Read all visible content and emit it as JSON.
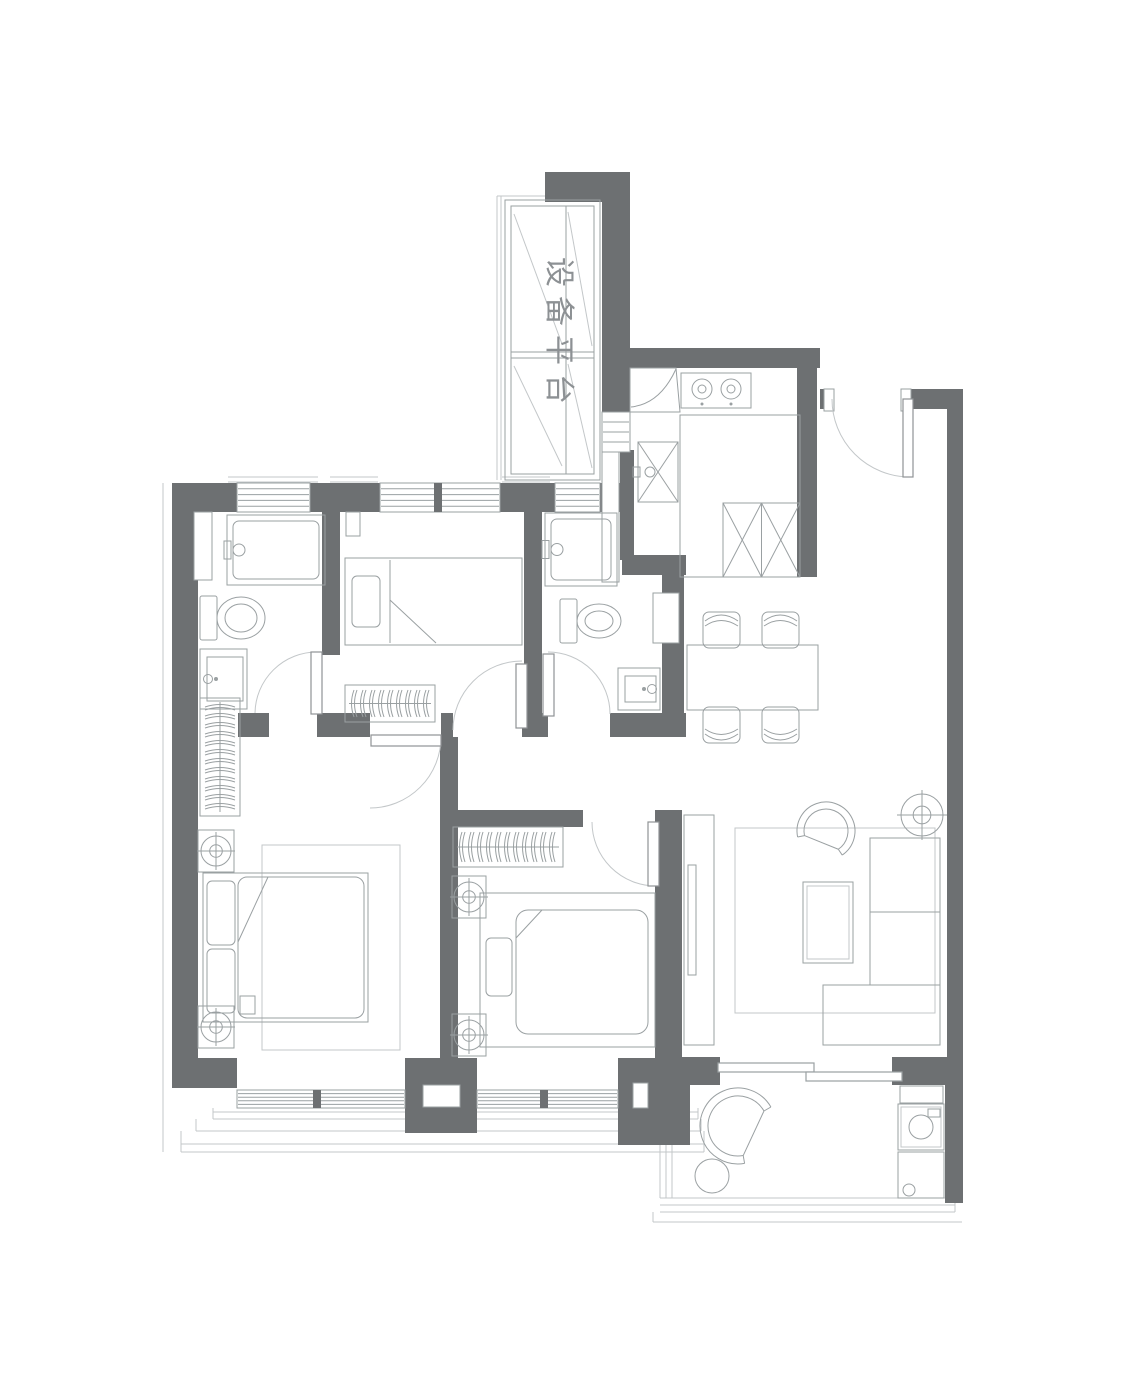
{
  "labels": {
    "equipment_platform": "设备平台"
  },
  "colors": {
    "wall": "#6d7072",
    "line": "#9aa0a2",
    "line_light": "#c3c7c9",
    "bg": "#ffffff",
    "text": "#8d9194"
  },
  "canvas": {
    "w": 1121,
    "h": 1400
  },
  "walls": [
    [
      172,
      483,
      26,
      605
    ],
    [
      172,
      483,
      65,
      29
    ],
    [
      310,
      483,
      70,
      29
    ],
    [
      500,
      483,
      55,
      29
    ],
    [
      600,
      483,
      34,
      29
    ],
    [
      545,
      172,
      85,
      30
    ],
    [
      602,
      202,
      28,
      210
    ],
    [
      620,
      450,
      14,
      110
    ],
    [
      602,
      348,
      218,
      20
    ],
    [
      797,
      368,
      20,
      209
    ],
    [
      820,
      389,
      12,
      20
    ],
    [
      906,
      389,
      57,
      20
    ],
    [
      947,
      409,
      16,
      650
    ],
    [
      892,
      1057,
      71,
      28
    ],
    [
      945,
      1085,
      18,
      118
    ],
    [
      682,
      1057,
      38,
      28
    ],
    [
      322,
      508,
      18,
      147
    ],
    [
      524,
      508,
      18,
      205
    ],
    [
      622,
      555,
      64,
      20
    ],
    [
      662,
      560,
      22,
      171
    ],
    [
      238,
      713,
      31,
      24
    ],
    [
      317,
      713,
      53,
      24
    ],
    [
      441,
      713,
      12,
      24
    ],
    [
      522,
      713,
      26,
      24
    ],
    [
      610,
      713,
      76,
      24
    ],
    [
      440,
      737,
      18,
      321
    ],
    [
      443,
      810,
      140,
      17
    ],
    [
      655,
      810,
      27,
      248
    ],
    [
      172,
      1058,
      65,
      30
    ],
    [
      405,
      1058,
      72,
      75
    ],
    [
      618,
      1058,
      72,
      87
    ]
  ],
  "wall_notches": [
    [
      423,
      1085,
      37,
      22
    ],
    [
      633,
      1083,
      15,
      25
    ],
    [
      653,
      593,
      26,
      50
    ],
    [
      346,
      512,
      14,
      24
    ],
    [
      194,
      512,
      18,
      68
    ],
    [
      602,
      452,
      17,
      130
    ]
  ],
  "windows": [
    {
      "x": 237,
      "y": 483,
      "w": 73,
      "h": 29,
      "o": "h",
      "n": 4
    },
    {
      "x": 380,
      "y": 483,
      "w": 120,
      "h": 29,
      "o": "h",
      "n": 4,
      "m": [
        438
      ]
    },
    {
      "x": 555,
      "y": 483,
      "w": 45,
      "h": 29,
      "o": "h",
      "n": 4
    },
    {
      "x": 602,
      "y": 412,
      "w": 28,
      "h": 40,
      "o": "h",
      "n": 3
    },
    {
      "x": 237,
      "y": 1090,
      "w": 168,
      "h": 18,
      "o": "h",
      "n": 4,
      "m": [
        317
      ]
    },
    {
      "x": 477,
      "y": 1090,
      "w": 141,
      "h": 18,
      "o": "h",
      "n": 4,
      "m": [
        544
      ]
    }
  ],
  "doors": [
    {
      "name": "entry-door",
      "leaf": [
        903,
        399,
        10,
        78
      ],
      "arc": "M832,399 A78,78 0 0 0 910,477",
      "posts": [
        [
          824,
          389,
          10,
          22
        ],
        [
          901,
          389,
          10,
          22
        ]
      ]
    },
    {
      "name": "bathroom1-door",
      "leaf": [
        311,
        652,
        11,
        62
      ],
      "arc": "M255,713 A62,62 0 0 1 317,652"
    },
    {
      "name": "master-bedroom-door",
      "leaf": [
        371,
        735,
        70,
        11
      ],
      "arc": "M441,737 A71,71 0 0 1 370,808"
    },
    {
      "name": "bedroom3-door",
      "leaf": [
        516,
        664,
        11,
        64
      ],
      "arc": "M453,730 A69,69 0 0 1 522,661"
    },
    {
      "name": "bathroom2-door",
      "leaf": [
        543,
        654,
        11,
        62
      ],
      "arc": "M548,652 A62,62 0 0 1 610,714"
    },
    {
      "name": "bedroom2-door",
      "leaf": [
        648,
        822,
        11,
        64
      ],
      "arc": "M592,822 A64,64 0 0 0 656,886"
    },
    {
      "name": "balcony-sliding-door",
      "slide": [
        [
          718,
          1063,
          96,
          9
        ],
        [
          806,
          1072,
          96,
          9
        ]
      ]
    }
  ],
  "furniture": [
    {
      "name": "equipment-platform-unit",
      "type": "platform",
      "x": 505,
      "y": 200,
      "w": 95,
      "h": 280
    },
    {
      "name": "kitchen-corner-cabinet",
      "type": "cornercab"
    },
    {
      "name": "kitchen-stove",
      "type": "stove",
      "x": 681,
      "y": 373,
      "w": 70,
      "h": 35
    },
    {
      "name": "kitchen-sink",
      "type": "sinkx",
      "x": 638,
      "y": 442,
      "w": 40,
      "h": 60
    },
    {
      "name": "kitchen-counter",
      "type": "rect",
      "x": 680,
      "y": 415,
      "w": 120,
      "h": 162
    },
    {
      "name": "kitchen-fridge",
      "type": "fridge",
      "x": 723,
      "y": 503,
      "w": 77,
      "h": 74
    },
    {
      "name": "bathroom1-shower",
      "type": "shower",
      "x": 227,
      "y": 515,
      "w": 98,
      "h": 70
    },
    {
      "name": "bathroom1-toilet",
      "type": "toilet",
      "tx": 200,
      "ty": 596,
      "rx": 24,
      "ry": 21
    },
    {
      "name": "bathroom1-vanity",
      "type": "vanity",
      "x": 200,
      "y": 649,
      "w": 47,
      "h": 60,
      "f": "l"
    },
    {
      "name": "bathroom2-shower",
      "type": "shower",
      "x": 545,
      "y": 513,
      "w": 72,
      "h": 73
    },
    {
      "name": "bathroom2-toilet",
      "type": "toilet",
      "tx": 560,
      "ty": 599,
      "rx": 22,
      "ry": 17
    },
    {
      "name": "bathroom2-vanity",
      "type": "vanity",
      "x": 618,
      "y": 668,
      "w": 42,
      "h": 42,
      "f": "r"
    },
    {
      "name": "bedroom3-bed",
      "type": "bedsingle",
      "x": 345,
      "y": 558,
      "w": 177,
      "h": 87
    },
    {
      "name": "bedroom3-radiator",
      "type": "radiator",
      "o": "h",
      "x": 345,
      "y": 685,
      "w": 90,
      "h": 37
    },
    {
      "name": "hall-radiator",
      "type": "radiator",
      "o": "v",
      "x": 200,
      "y": 698,
      "w": 40,
      "h": 118
    },
    {
      "name": "master-rug",
      "type": "rug",
      "x": 262,
      "y": 845,
      "w": 138,
      "h": 205
    },
    {
      "name": "master-bed",
      "type": "beddouble",
      "x": 203,
      "y": 873,
      "w": 165,
      "h": 149
    },
    {
      "name": "master-nightstand-top",
      "type": "nightstand",
      "x": 198,
      "y": 830,
      "w": 36,
      "h": 42
    },
    {
      "name": "master-nightstand-bottom",
      "type": "nightstand",
      "x": 198,
      "y": 1006,
      "w": 36,
      "h": 42
    },
    {
      "name": "bedroom2-radiator",
      "type": "radiator",
      "o": "h",
      "x": 453,
      "y": 827,
      "w": 110,
      "h": 40
    },
    {
      "name": "bedroom2-nightstand-top",
      "type": "nightstand",
      "x": 452,
      "y": 876,
      "w": 34,
      "h": 42
    },
    {
      "name": "bedroom2-nightstand-bottom",
      "type": "nightstand",
      "x": 452,
      "y": 1014,
      "w": 34,
      "h": 42
    },
    {
      "name": "bedroom2-bed",
      "type": "bed2",
      "x": 480,
      "y": 893,
      "w": 175,
      "h": 154
    },
    {
      "name": "dining-set",
      "type": "dining",
      "table": [
        687,
        645,
        131,
        65
      ],
      "chairs": [
        [
          703,
          612,
          1
        ],
        [
          762,
          612,
          1
        ],
        [
          703,
          707,
          0
        ],
        [
          762,
          707,
          0
        ]
      ]
    },
    {
      "name": "tv-console",
      "type": "tv",
      "x": 684,
      "y": 815,
      "w": 30,
      "h": 230
    },
    {
      "name": "living-rug",
      "type": "rug",
      "x": 735,
      "y": 828,
      "w": 200,
      "h": 185
    },
    {
      "name": "living-armchair",
      "type": "cchair",
      "cx": 826,
      "cy": 831,
      "r1": 29,
      "r2": 22,
      "gap": 112,
      "half": 56
    },
    {
      "name": "floor-lamp",
      "type": "lamp",
      "cx": 922,
      "cy": 815,
      "r": 21
    },
    {
      "name": "living-sofa",
      "type": "multirect",
      "parts": [
        [
          870,
          838,
          70,
          74
        ],
        [
          870,
          912,
          70,
          73
        ],
        [
          823,
          985,
          117,
          60
        ]
      ]
    },
    {
      "name": "coffee-table",
      "type": "ctable",
      "x": 803,
      "y": 882,
      "w": 50,
      "h": 81
    },
    {
      "name": "balcony-lounge-chair",
      "type": "cchair",
      "cx": 738,
      "cy": 1126,
      "r1": 38,
      "r2": 30,
      "gap": 25,
      "half": 55
    },
    {
      "name": "balcony-side-table",
      "type": "circle",
      "cx": 712,
      "cy": 1176,
      "r": 17
    },
    {
      "name": "balcony-cabinet-top",
      "type": "rect",
      "x": 900,
      "y": 1086,
      "w": 43,
      "h": 17
    },
    {
      "name": "balcony-washer",
      "type": "washer",
      "x": 898,
      "y": 1104,
      "w": 46,
      "h": 46
    },
    {
      "name": "balcony-cabinet-bottom",
      "type": "rect",
      "x": 898,
      "y": 1152,
      "w": 46,
      "h": 46
    },
    {
      "name": "balcony-drain",
      "type": "circle",
      "cx": 909,
      "cy": 1190,
      "r": 6
    }
  ],
  "lines": [
    [
      163,
      483,
      163,
      1152
    ],
    [
      228,
      477,
      318,
      477
    ],
    [
      228,
      482,
      318,
      482
    ],
    [
      330,
      477,
      378,
      477
    ],
    [
      330,
      482,
      378,
      482
    ],
    [
      502,
      477,
      550,
      477
    ],
    [
      502,
      482,
      550,
      482
    ],
    [
      497,
      196,
      497,
      480
    ],
    [
      501,
      196,
      501,
      480
    ],
    [
      497,
      196,
      545,
      196
    ],
    [
      213,
      1112,
      698,
      1112
    ],
    [
      213,
      1119,
      698,
      1119
    ],
    [
      196,
      1131,
      701,
      1131
    ],
    [
      181,
      1144,
      704,
      1144
    ],
    [
      181,
      1152,
      704,
      1152
    ],
    [
      213,
      1108,
      213,
      1119
    ],
    [
      196,
      1119,
      196,
      1131
    ],
    [
      181,
      1131,
      181,
      1152
    ],
    [
      698,
      1108,
      698,
      1119
    ],
    [
      701,
      1119,
      701,
      1131
    ],
    [
      704,
      1131,
      704,
      1152
    ],
    [
      660,
      1085,
      660,
      1198
    ],
    [
      666,
      1085,
      666,
      1198
    ],
    [
      672,
      1085,
      672,
      1198
    ],
    [
      660,
      1198,
      955,
      1198
    ],
    [
      660,
      1205,
      955,
      1205
    ],
    [
      660,
      1212,
      955,
      1212
    ],
    [
      653,
      1222,
      962,
      1222
    ],
    [
      955,
      1198,
      955,
      1212
    ],
    [
      653,
      1212,
      653,
      1222
    ]
  ]
}
